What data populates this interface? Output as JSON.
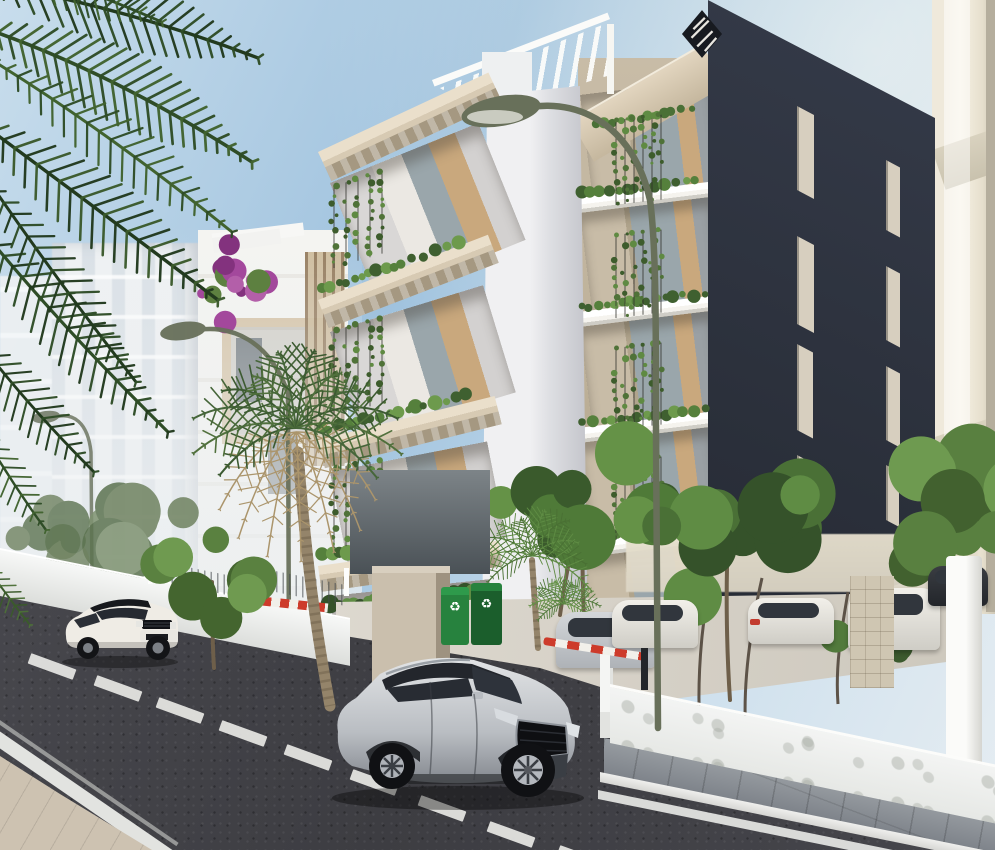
{
  "scene": {
    "label": "architectural-render-street-view",
    "width": 995,
    "height": 850
  },
  "palette": {
    "sky_top": "#9fc2de",
    "sky_mid": "#c8ddec",
    "sky_low": "#e6edf2",
    "far_bld": "#eef1f3",
    "far_win": "#d9e0e6",
    "near_bld": "#f4f4f1",
    "tan_frame": "#d5c3a6",
    "wood": "#8a6f4e",
    "cream": "#efe9db",
    "cream_sh": "#d9d2bf",
    "cream_dark": "#b5ae9d",
    "dark1": "#2b303b",
    "dark2": "#1f232c",
    "win_dark": "#d7cfbf",
    "beige_slab": "#d7cab3",
    "beige_slab2": "#c2b49c",
    "beige_under": "#a59881",
    "beige_wall": "#c8bca7",
    "white_slab": "#f5f3ee",
    "white_under": "#cfcdc6",
    "pillar_l": "#f0f0f2",
    "pillar_d": "#c3c4ca",
    "curtain": "#ebe8e3",
    "glass": "#9aa6ab",
    "wood_in": "#c9a87d",
    "lamp": "#68705a",
    "trunk": "#94846a",
    "trunk_d": "#6e5f4a",
    "palm_dry": "#ab956c",
    "road": "#3d3d42",
    "road_l": "#4c4c52",
    "dash": "#e8e8e5",
    "paver": "#989da2",
    "paver_d": "#7e838a",
    "curb": "#d6d6d3",
    "line": "#e2e3e0",
    "pave_beige": "#cdc2b1",
    "wall_w": "#f3f4f3",
    "wall_sh": "#dcdedb",
    "distant": "#ddd6c6",
    "stone": "#cfc6b2",
    "tail": "#c23b2e",
    "barrier_r": "#cd3b2b",
    "bin": "#27823e",
    "bin_d": "#1b5e2c",
    "logo": "#171a20"
  },
  "icons": {
    "recycle_glyph": "♻"
  },
  "dark_windows": [
    {
      "x": 797,
      "y": 106,
      "w": 17,
      "h": 84
    },
    {
      "x": 797,
      "y": 236,
      "w": 17,
      "h": 88
    },
    {
      "x": 797,
      "y": 344,
      "w": 16,
      "h": 86
    },
    {
      "x": 797,
      "y": 455,
      "w": 16,
      "h": 72
    },
    {
      "x": 886,
      "y": 160,
      "w": 14,
      "h": 70
    },
    {
      "x": 886,
      "y": 266,
      "w": 14,
      "h": 74
    },
    {
      "x": 886,
      "y": 366,
      "w": 14,
      "h": 74
    },
    {
      "x": 886,
      "y": 465,
      "w": 13,
      "h": 55
    }
  ],
  "lane_dashes": [
    [
      52,
      666
    ],
    [
      118,
      688
    ],
    [
      180,
      710
    ],
    [
      243,
      733
    ],
    [
      308,
      757
    ],
    [
      374,
      782
    ],
    [
      442,
      808
    ],
    [
      511,
      834
    ],
    [
      581,
      858
    ]
  ],
  "parked_cars": [
    {
      "x": 556,
      "y": 612,
      "w": 100,
      "h": 56,
      "body": "sil",
      "tail": "right"
    },
    {
      "x": 612,
      "y": 600,
      "w": 86,
      "h": 48,
      "body": "white"
    },
    {
      "x": 748,
      "y": 598,
      "w": 86,
      "h": 46,
      "body": "white",
      "tail": "left"
    },
    {
      "x": 848,
      "y": 588,
      "w": 92,
      "h": 62,
      "body": "white",
      "tail": "left"
    },
    {
      "x": 928,
      "y": 566,
      "w": 60,
      "h": 40,
      "body": "dark"
    }
  ],
  "lamps": {
    "main": {
      "pole": "M505 114 C560 92 630 112 650 200 C656 244 656 320 656 436 L658 728",
      "head": [
        501,
        111,
        40,
        15,
        -10
      ],
      "lens": [
        495,
        117,
        28,
        7
      ]
    },
    "back": [
      {
        "pole": "M188 332 C232 320 272 344 288 394 L289 664",
        "head": [
          183,
          331,
          23,
          9,
          -8
        ],
        "w": 4.5,
        "op": 0.95
      },
      {
        "pole": "M52 418 C74 410 88 424 91 452 L92 580",
        "head": [
          46,
          417,
          14,
          6,
          -8
        ],
        "w": 3.5,
        "op": 0.8
      }
    ]
  },
  "veg": {
    "back_trees": [
      {
        "cx": 118,
        "cy": 520,
        "s": 70,
        "n": 9,
        "seed": 31,
        "op": 0.85,
        "cols": [
          "#6f8260",
          "#5c7350",
          "#7e9270"
        ],
        "trunks": [
          "M118 596 C116 560 118 540 118 520"
        ],
        "tw": 3
      },
      {
        "cx": 38,
        "cy": 540,
        "s": 55,
        "n": 7,
        "seed": 17,
        "op": 0.8,
        "cols": [
          "#6f8260",
          "#5c7350"
        ]
      },
      {
        "cx": 945,
        "cy": 515,
        "s": 88,
        "n": 11,
        "seed": 41,
        "cols": [
          "#42612f",
          "#598040",
          "#6e9a50"
        ]
      },
      {
        "cx": 872,
        "cy": 636,
        "s": 40,
        "n": 7,
        "seed": 23,
        "cols": [
          "#3c5a2e",
          "#527a3c"
        ]
      },
      {
        "cx": 582,
        "cy": 500,
        "s": 82,
        "n": 11,
        "seed": 53,
        "cols": [
          "#3a5a2c",
          "#4f7a38",
          "#659247"
        ],
        "trunks": [
          "M584 620 C582 570 582 535 582 500",
          "M560 615 C566 570 574 540 580 512"
        ],
        "tw": 4
      },
      {
        "cx": 728,
        "cy": 535,
        "s": 96,
        "n": 12,
        "seed": 61,
        "cols": [
          "#35522a",
          "#4a7036",
          "#5f8c44"
        ],
        "trunks": [
          "M730 700 C726 640 726 580 728 540"
        ],
        "tw": 4
      }
    ],
    "front_trees": [
      {
        "cx": 212,
        "cy": 580,
        "s": 62,
        "n": 9,
        "seed": 71,
        "cols": [
          "#44652f",
          "#5a8140",
          "#6f9a50"
        ],
        "trunks": [
          "M214 668 C212 636 212 608 212 582"
        ],
        "tw": 4
      }
    ],
    "trunks_back": [
      "M700 732 C696 668 704 606 714 562",
      "M746 736 C742 682 752 622 762 578",
      "M838 704 C835 664 842 628 848 592"
    ],
    "palms_back": [
      {
        "cx": 532,
        "cy": 556,
        "L": 58,
        "n": 10,
        "droop": 0.5,
        "cols": [
          "#4a7034",
          "#5f8c44"
        ],
        "trunk": "M532 560 C534 592 536 618 538 648",
        "tw": 6
      },
      {
        "cx": 564,
        "cy": 604,
        "L": 34,
        "n": 8,
        "droop": 0.55,
        "cols": [
          "#527a3c",
          "#659247"
        ]
      }
    ],
    "palms_front": [
      {
        "cx": 296,
        "cy": 428,
        "L": 100,
        "n": 12,
        "droop": 0.55,
        "dry": 7,
        "cols": [
          "#3c5a31",
          "#50703c",
          "#46663a"
        ],
        "trunk": "M298 452 C306 560 316 630 330 706",
        "tw": 11
      }
    ],
    "hedgerows": [
      {
        "x0": 322,
        "x1": 468,
        "y": 290,
        "k": -0.34,
        "r": 5,
        "seed": 3,
        "cols": [
          "#3f6030",
          "#55803c",
          "#6d9a4c"
        ]
      },
      {
        "x0": 322,
        "x1": 468,
        "y": 430,
        "k": -0.24,
        "r": 5,
        "seed": 4,
        "cols": [
          "#3f6030",
          "#55803c",
          "#6d9a4c"
        ]
      },
      {
        "x0": 322,
        "x1": 468,
        "y": 556,
        "k": -0.15,
        "r": 5.5,
        "seed": 5,
        "cols": [
          "#3f6030",
          "#55803c",
          "#6d9a4c"
        ]
      },
      {
        "x0": 330,
        "x1": 474,
        "y": 606,
        "k": -0.1,
        "r": 7,
        "seed": 6,
        "cols": [
          "#35522a",
          "#4a7036",
          "#5f8c44"
        ]
      },
      {
        "x0": 582,
        "x1": 706,
        "y": 194,
        "k": -0.12,
        "r": 4.5,
        "seed": 7,
        "cols": [
          "#3f6030",
          "#55803c",
          "#6d9a4c"
        ]
      },
      {
        "x0": 582,
        "x1": 706,
        "y": 308,
        "k": -0.12,
        "r": 4.5,
        "seed": 8,
        "cols": [
          "#3f6030",
          "#55803c",
          "#6d9a4c"
        ]
      },
      {
        "x0": 582,
        "x1": 706,
        "y": 424,
        "k": -0.12,
        "r": 4.5,
        "seed": 9,
        "cols": [
          "#3f6030",
          "#55803c",
          "#6d9a4c"
        ]
      },
      {
        "x0": 582,
        "x1": 706,
        "y": 539,
        "k": -0.12,
        "r": 5,
        "seed": 10,
        "cols": [
          "#3f6030",
          "#55803c",
          "#6d9a4c"
        ]
      },
      {
        "x0": 596,
        "x1": 700,
        "y": 126,
        "k": -0.18,
        "r": 4,
        "seed": 11,
        "cols": [
          "#4a7036",
          "#5f8c44"
        ]
      }
    ],
    "vine_specs": [
      {
        "x0": 334,
        "x1": 392,
        "step": 12,
        "y0": 186,
        "y1": 268,
        "k": -0.3
      },
      {
        "x0": 334,
        "x1": 392,
        "step": 12,
        "y0": 330,
        "y1": 415,
        "k": -0.24
      },
      {
        "x0": 334,
        "x1": 392,
        "step": 12,
        "y0": 468,
        "y1": 548,
        "k": -0.16
      },
      {
        "x0": 616,
        "x1": 664,
        "step": 9,
        "y0": 120,
        "y1": 205,
        "k": -0.12
      },
      {
        "x0": 616,
        "x1": 664,
        "step": 9,
        "y0": 235,
        "y1": 318,
        "k": -0.12
      },
      {
        "x0": 616,
        "x1": 664,
        "step": 9,
        "y0": 348,
        "y1": 430,
        "k": -0.12
      },
      {
        "x0": 616,
        "x1": 664,
        "step": 9,
        "y0": 462,
        "y1": 540,
        "k": -0.12
      }
    ],
    "fronds": [
      {
        "p0": [
          -30,
          -20
        ],
        "c": [
          120,
          5
        ],
        "p1": [
          258,
          58
        ],
        "leaf": 40,
        "w": 3.4,
        "m": 22,
        "c1": "#223a1e",
        "c2": "#2f4d27"
      },
      {
        "p0": [
          -25,
          25
        ],
        "c": [
          110,
          70
        ],
        "p1": [
          252,
          162
        ],
        "leaf": 44,
        "w": 3.6,
        "m": 24,
        "c1": "#2f4d27",
        "c2": "#41632f"
      },
      {
        "p0": [
          -30,
          115
        ],
        "c": [
          92,
          205
        ],
        "p1": [
          218,
          300
        ],
        "leaf": 42,
        "w": 3.4,
        "m": 22,
        "c1": "#223a1e",
        "c2": "#3b5a2c"
      },
      {
        "p0": [
          -22,
          225
        ],
        "c": [
          62,
          328
        ],
        "p1": [
          168,
          432
        ],
        "leaf": 38,
        "w": 3.2,
        "m": 20,
        "c1": "#2f4d27",
        "c2": "#223a1e"
      },
      {
        "p0": [
          -30,
          330
        ],
        "c": [
          22,
          400
        ],
        "p1": [
          94,
          472
        ],
        "leaf": 30,
        "w": 2.8,
        "m": 16,
        "c1": "#223a1e",
        "c2": "#2f4d27"
      },
      {
        "p0": [
          -20,
          -45
        ],
        "c": [
          70,
          -18
        ],
        "p1": [
          162,
          22
        ],
        "leaf": 30,
        "w": 2.8,
        "m": 16,
        "c1": "#2f4d27",
        "c2": "#41632f"
      },
      {
        "p0": [
          -5,
          62
        ],
        "c": [
          108,
          132
        ],
        "p1": [
          232,
          232
        ],
        "leaf": 34,
        "w": 3,
        "m": 20,
        "c1": "#41632f",
        "c2": "#2f4d27"
      },
      {
        "p0": [
          -12,
          180
        ],
        "c": [
          58,
          282
        ],
        "p1": [
          136,
          382
        ],
        "leaf": 32,
        "w": 3,
        "m": 18,
        "c1": "#223a1e",
        "c2": "#2f4d27"
      },
      {
        "p0": [
          -25,
          420
        ],
        "c": [
          8,
          478
        ],
        "p1": [
          46,
          530
        ],
        "leaf": 22,
        "w": 2.4,
        "m": 12,
        "c1": "#2f4d27",
        "c2": "#41632f"
      },
      {
        "p0": [
          -18,
          560
        ],
        "c": [
          4,
          592
        ],
        "p1": [
          30,
          625
        ],
        "leaf": 16,
        "w": 2,
        "m": 10,
        "c1": "#3b5a2c",
        "c2": "#4d7038"
      }
    ],
    "bougain": {
      "cx": 233,
      "cy": 282,
      "s": 38,
      "n": 14,
      "seed": 21,
      "cols": [
        "#a3489c",
        "#83327e",
        "#b35fa9",
        "#5d8040"
      ],
      "planter": [
        212,
        238,
        68,
        15,
        -8
      ]
    }
  }
}
